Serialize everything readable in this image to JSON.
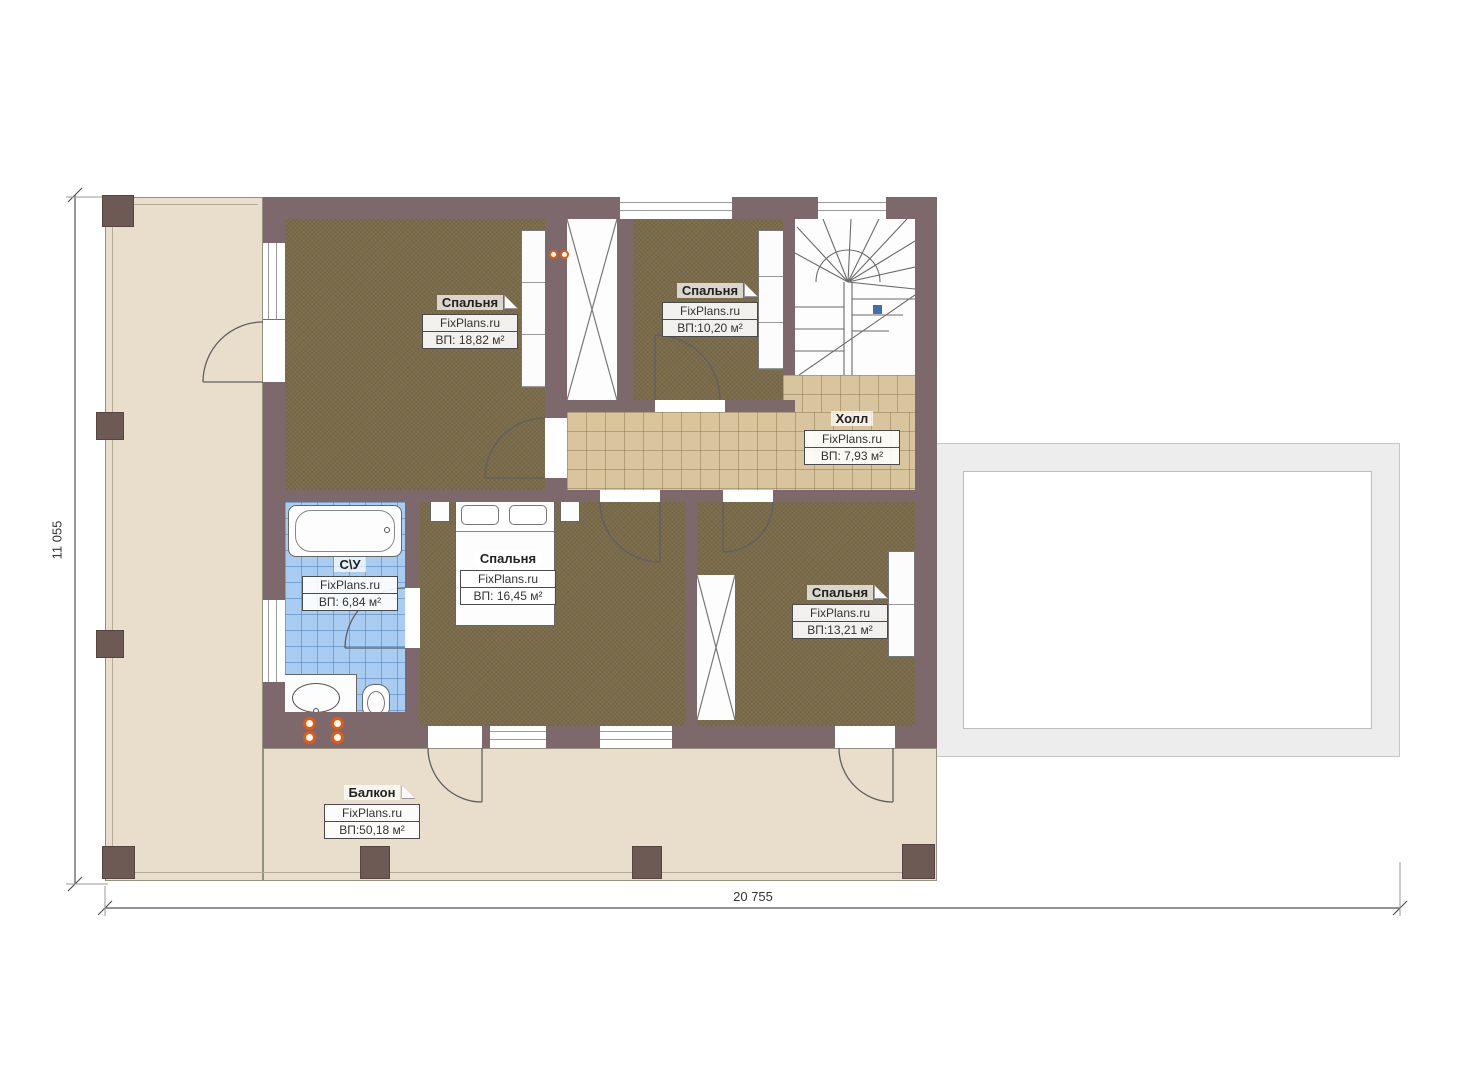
{
  "plan": {
    "watermark": "FixPlans.ru",
    "dimensions": {
      "height_label": "11 055",
      "width_label": "20 755"
    },
    "rooms": [
      {
        "id": "bedroom-1",
        "name": "Спальня",
        "area": "ВП: 18,82 м²"
      },
      {
        "id": "bedroom-2",
        "name": "Спальня",
        "area": "ВП:10,20 м²"
      },
      {
        "id": "hall",
        "name": "Холл",
        "area": "ВП: 7,93 м²"
      },
      {
        "id": "bathroom",
        "name": "С\\У",
        "area": "ВП: 6,84 м²"
      },
      {
        "id": "bedroom-3",
        "name": "Спальня",
        "area": "ВП: 16,45 м²"
      },
      {
        "id": "bedroom-4",
        "name": "Спальня",
        "area": "ВП:13,21 м²"
      },
      {
        "id": "balcony",
        "name": "Балкон",
        "area": "ВП:50,18 м²"
      }
    ],
    "colors": {
      "wall": "#7d696b",
      "pillar": "#6d5a55",
      "bedroom_floor": "#7a6b4a",
      "hall_tile": "#d9c59d",
      "bath_tile": "#a9cdf0",
      "terrace": "#e8decb",
      "roof_band": "#ededed",
      "radiator": "#e8590c",
      "stair_marker": "#3f6fae"
    }
  }
}
